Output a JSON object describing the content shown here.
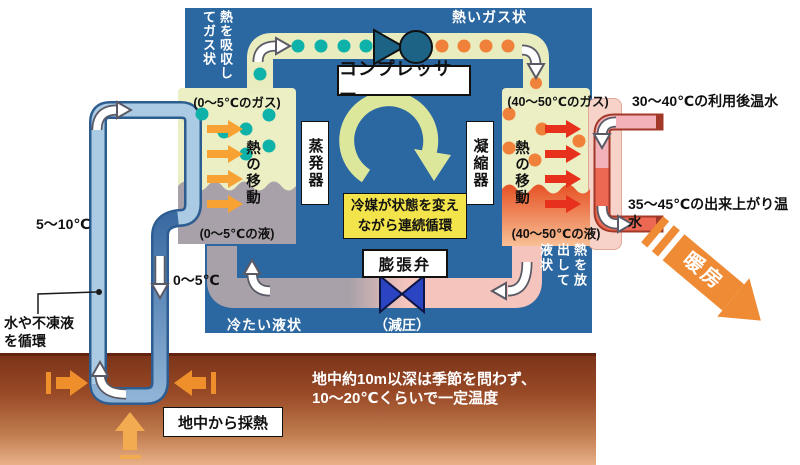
{
  "cycle": {
    "compressor_label": "コンプレッサー",
    "hot_gas_label": "熱いガス状",
    "absorb_heat_label": "熱を吸収してガス状",
    "release_heat_label": "熱を放出して液状",
    "evaporator_label": "蒸発器",
    "condenser_label": "凝縮器",
    "heat_transfer_left": "熱の移動",
    "heat_transfer_right": "熱の移動",
    "gas_state_left": "(0～5℃のガス)",
    "liquid_state_left": "(0～5℃の液)",
    "gas_state_right": "(40～50℃のガス)",
    "liquid_state_right": "(40～50℃の液)",
    "refrigerant_note_line1": "冷媒が状態を変え",
    "refrigerant_note_line2": "ながら連続循環",
    "expansion_valve_label": "膨張弁",
    "decompression_label": "（減圧）",
    "cold_liquid_label": "冷たい液状"
  },
  "ground_loop": {
    "supply_temp": "5～10℃",
    "return_temp": "0～5℃",
    "fluid_note_line1": "水や不凍液",
    "fluid_note_line2": "を循環",
    "heat_collect_label": "地中から採熱"
  },
  "water_loop": {
    "return_water": "30～40℃の利用後温水",
    "supply_water": "35～45℃の出来上がり温水",
    "heating_label": "暖房"
  },
  "ground": {
    "note_line1": "地中約10m以深は季節を問わず、",
    "note_line2": "10～20℃くらいで一定温度"
  },
  "colors": {
    "unit_blue": "#2b67a0",
    "refrigerant_pipe": "#e9ecbe",
    "cold_gas_dot": "#0fb2a8",
    "hot_gas_dot": "#f0813a",
    "cold_liquid_gray": "#a9a1a9",
    "hot_liquid_orange": "#e7582b",
    "heat_arrow_orange": "#f7a233",
    "heat_arrow_red": "#e8311c",
    "compressor_teal": "#1c6386",
    "expansion_valve_blue": "#2a44c2",
    "water_in_pink": "#f3b1ba",
    "water_out_salmon": "#ed6852",
    "loop_light_blue": "#abcae3",
    "loop_dark_blue": "#5586ba",
    "ground_brown": "#7c3418",
    "heating_arrow_orange": "#ef8a35",
    "note_yellow": "#f3e44b"
  }
}
